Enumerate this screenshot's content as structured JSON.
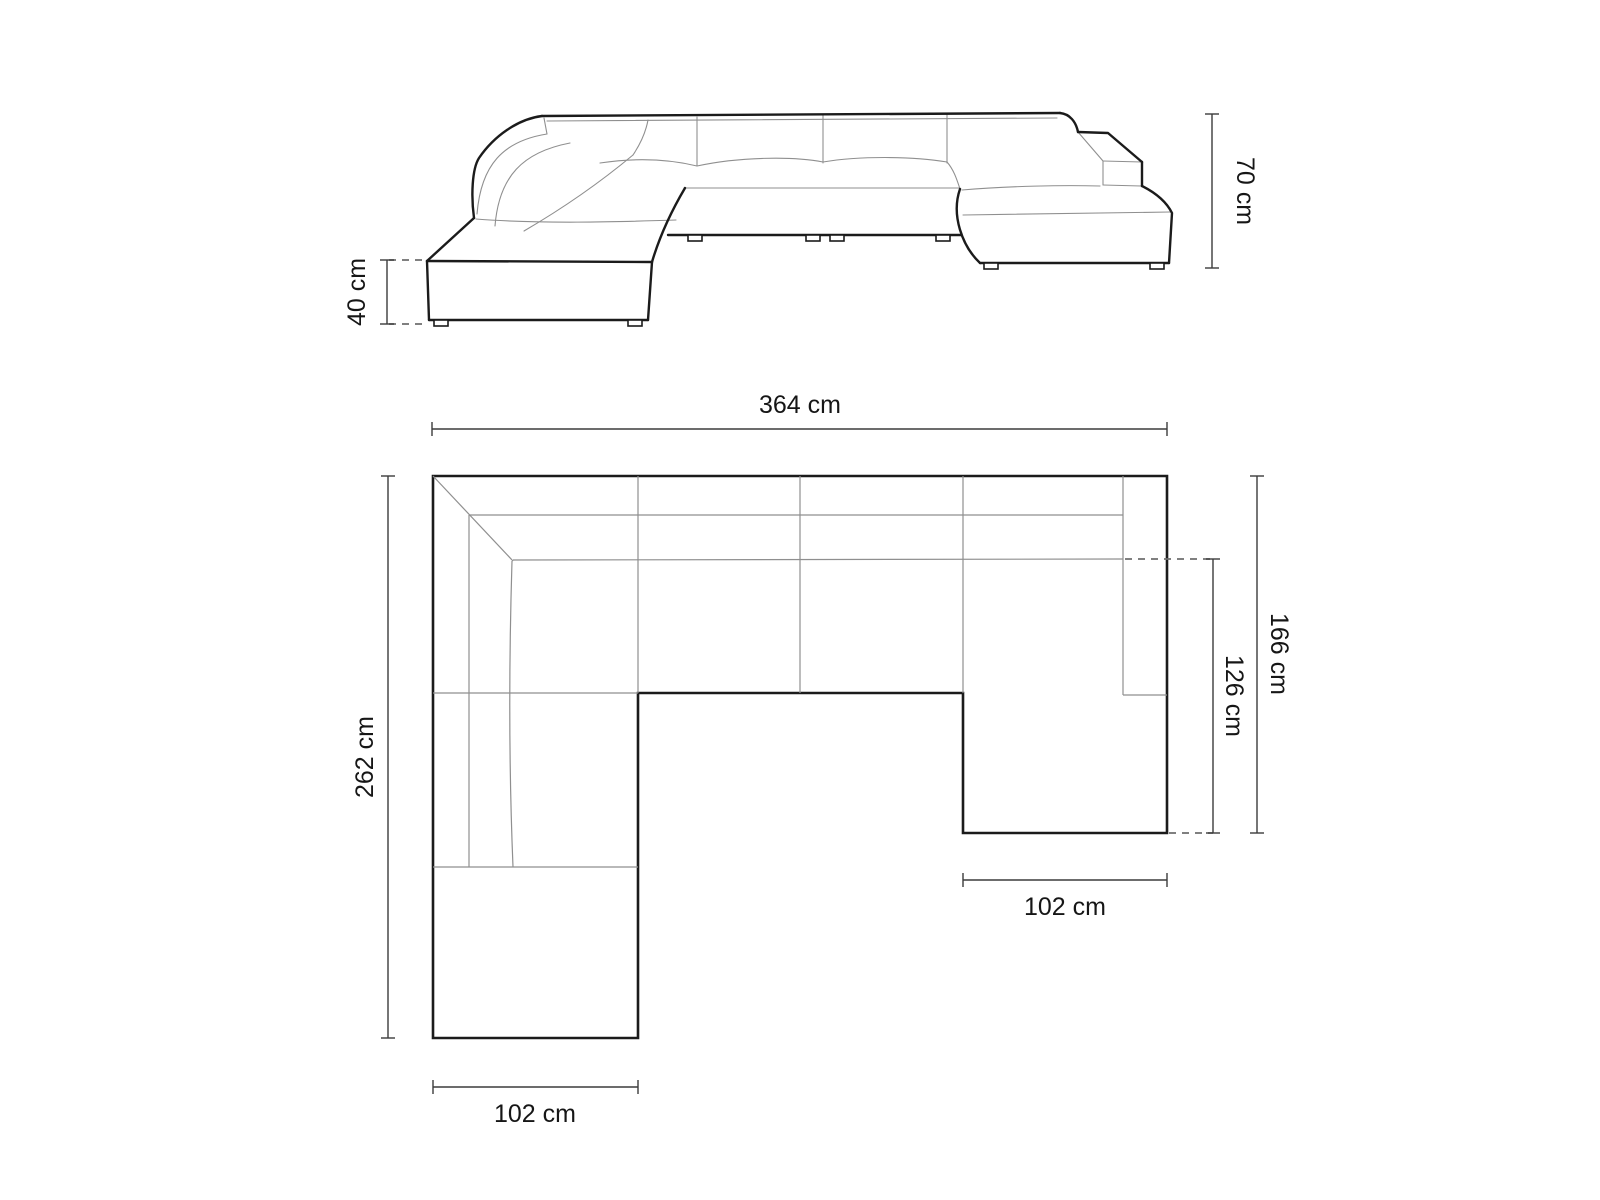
{
  "page": {
    "background": "#ffffff",
    "description": "U-shaped modular sofa dimension drawing"
  },
  "colors": {
    "outline": "#1b1b1b",
    "seam": "#8f8f8f",
    "dimension": "#3c3c3c",
    "dash": "#6f6f6f",
    "label": "#161616"
  },
  "side_view": {
    "height_total": {
      "label": "70 cm",
      "value": 70,
      "unit": "cm"
    },
    "height_seat": {
      "label": "40 cm",
      "value": 40,
      "unit": "cm"
    }
  },
  "plan_view": {
    "width_total": {
      "label": "364 cm",
      "value": 364,
      "unit": "cm"
    },
    "depth_left": {
      "label": "262 cm",
      "value": 262,
      "unit": "cm"
    },
    "depth_right": {
      "label": "166 cm",
      "value": 166,
      "unit": "cm"
    },
    "depth_right_inner": {
      "label": "126 cm",
      "value": 126,
      "unit": "cm"
    },
    "width_chaise_left": {
      "label": "102 cm",
      "value": 102,
      "unit": "cm"
    },
    "width_chaise_right": {
      "label": "102 cm",
      "value": 102,
      "unit": "cm"
    }
  }
}
